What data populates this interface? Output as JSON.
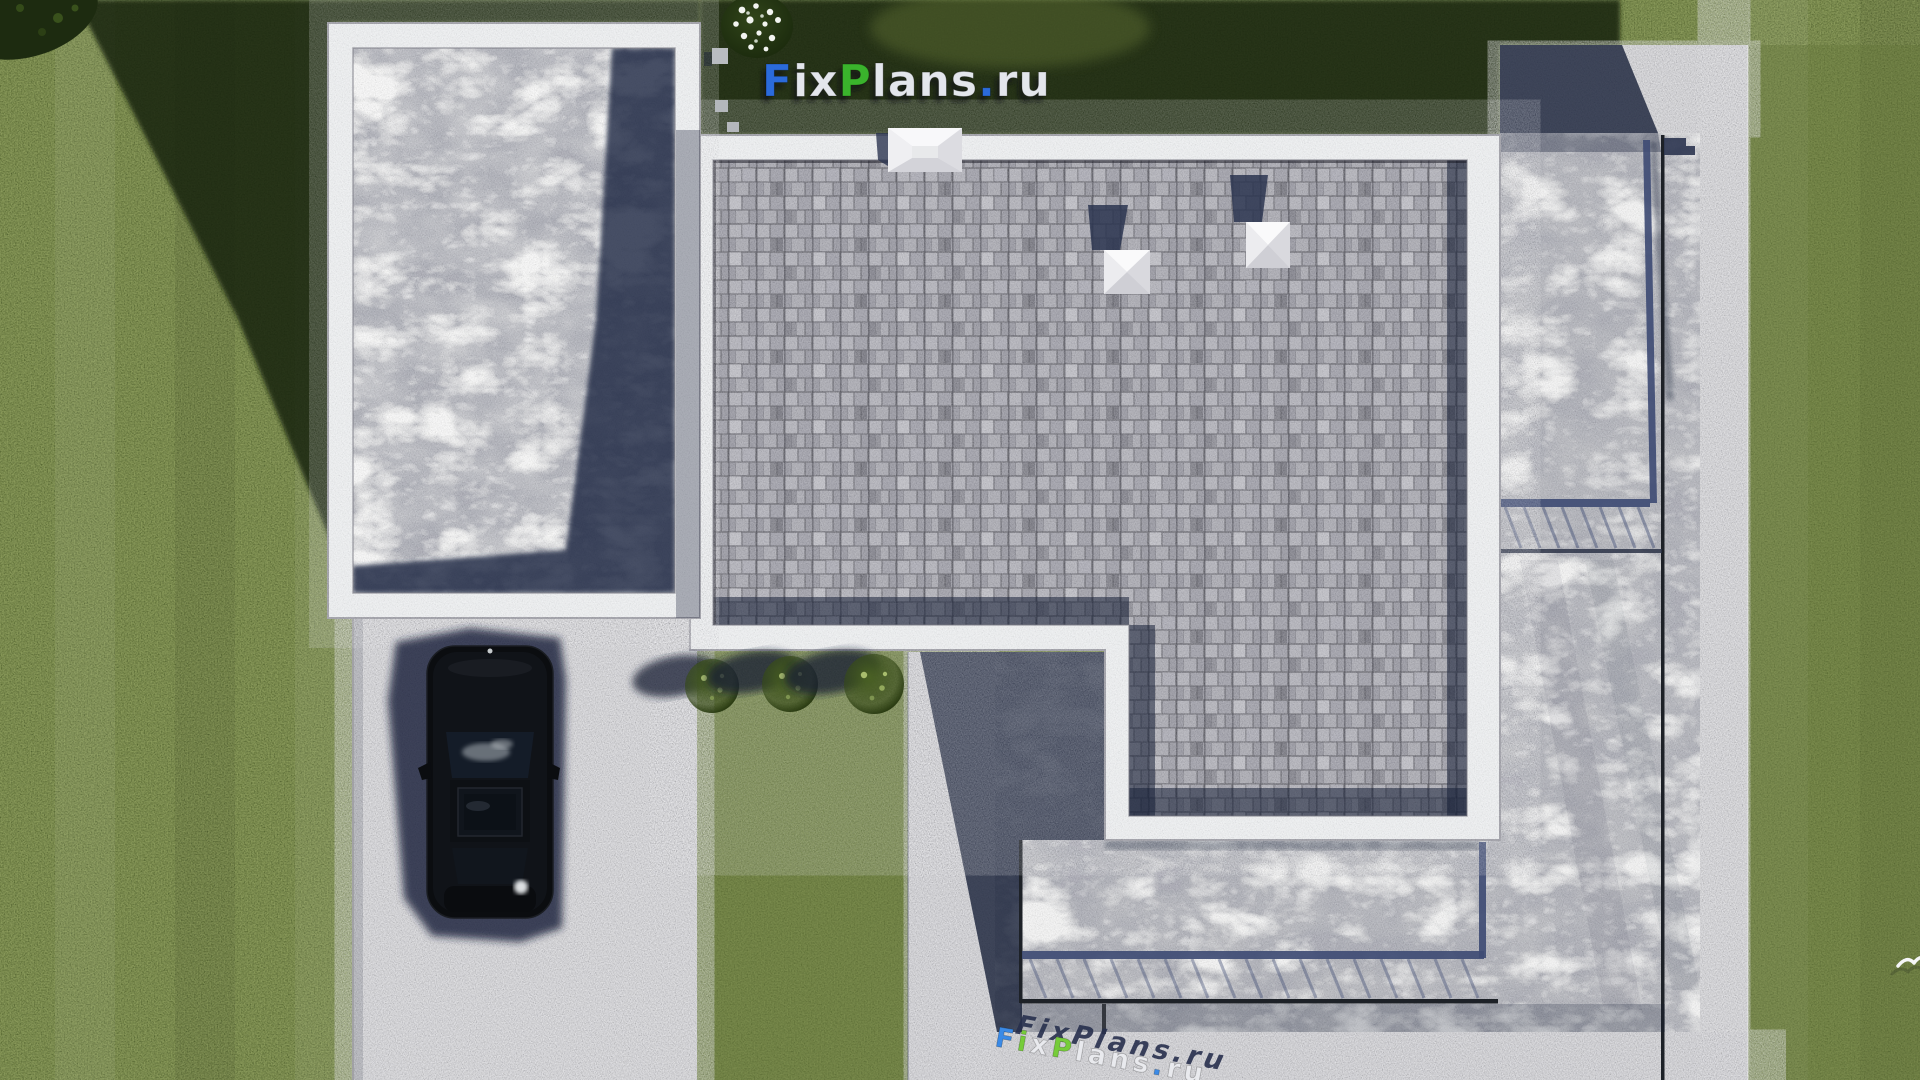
{
  "site": {
    "brand": "FixPlans.ru",
    "view": "aerial roof plan render"
  },
  "logo": {
    "f": "F",
    "ix": "ix",
    "p": "P",
    "lans": "lans",
    "dot": ".",
    "ru": "ru",
    "blue": "#2b6bdb",
    "green": "#3ab32c",
    "light": "#e3e6ec"
  },
  "watermark": {
    "f": "F",
    "i": "i",
    "x": "x",
    "p": "P",
    "lans": "lans",
    "dot": ".",
    "ru": "ru",
    "blue": "#3b8ae6",
    "green": "#76cc3a",
    "light": "#e9eaee"
  },
  "palette": {
    "grass": "#5a6b31",
    "grass_shadow": "#16200d",
    "concrete": "#c9c9cc",
    "marble": "#b6b7bb",
    "marble_light": "#c8c9cc",
    "parapet_white": "#eef0f1",
    "shingle_gray": "#94949e",
    "hard_shadow_navy": "#182038",
    "railing_navy": "#3f4c74",
    "car_black": "#0b0d10"
  }
}
